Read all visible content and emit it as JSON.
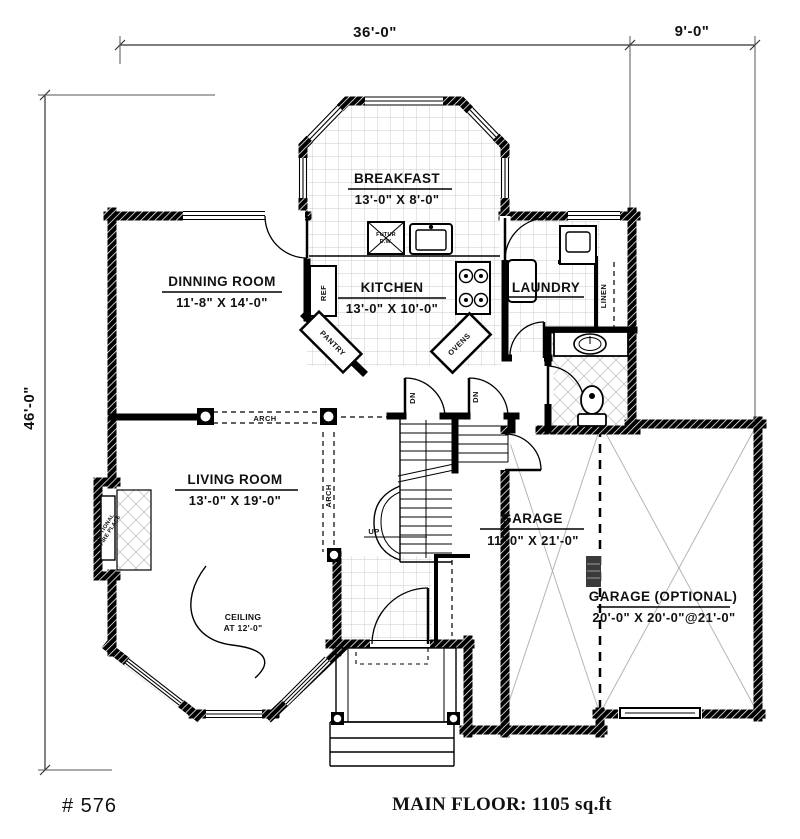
{
  "footer": {
    "plan_number": "# 576",
    "main_floor": "MAIN FLOOR: 1105 sq.ft"
  },
  "dimensions": {
    "top_main": "36'-0\"",
    "top_right": "9'-0\"",
    "left_total": "46'-0\""
  },
  "rooms": {
    "breakfast": {
      "name": "BREAKFAST",
      "size": "13'-0\" X 8'-0\""
    },
    "dinning_room": {
      "name": "DINNING ROOM",
      "size": "11'-8\" X 14'-0\""
    },
    "kitchen": {
      "name": "KITCHEN",
      "size": "13'-0\" X 10'-0\""
    },
    "laundry": {
      "name": "LAUNDRY"
    },
    "living_room": {
      "name": "LIVING ROOM",
      "size": "13'-0\" X 19'-0\""
    },
    "garage": {
      "name": "GARAGE",
      "size": "11'-0\" X 21'-0\""
    },
    "garage_optional": {
      "name": "GARAGE (OPTIONAL)",
      "size": "20'-0\" X 20'-0\"@21'-0\""
    }
  },
  "annotations": {
    "ceiling_line1": "CEILING",
    "ceiling_line2": "AT 12'-0\"",
    "fireplace_line1": "OPTIONAL",
    "fireplace_line2": "FIRE PLACE",
    "arch_horizontal": "ARCH",
    "arch_vertical": "ARCH",
    "pantry": "PANTRY",
    "ovens": "OVENS",
    "refrigerator": "REF",
    "linen": "LINEN",
    "future_dw_line1": "FUTUR",
    "future_dw_line2": "D.W.",
    "stairs_down_left": "DN",
    "stairs_down_right": "DN",
    "stairs_up": "UP"
  },
  "colors": {
    "walls": "#000000",
    "tile_grid": "#c9c9c9",
    "garage_lines": "#b5b5b5",
    "background": "#ffffff"
  }
}
